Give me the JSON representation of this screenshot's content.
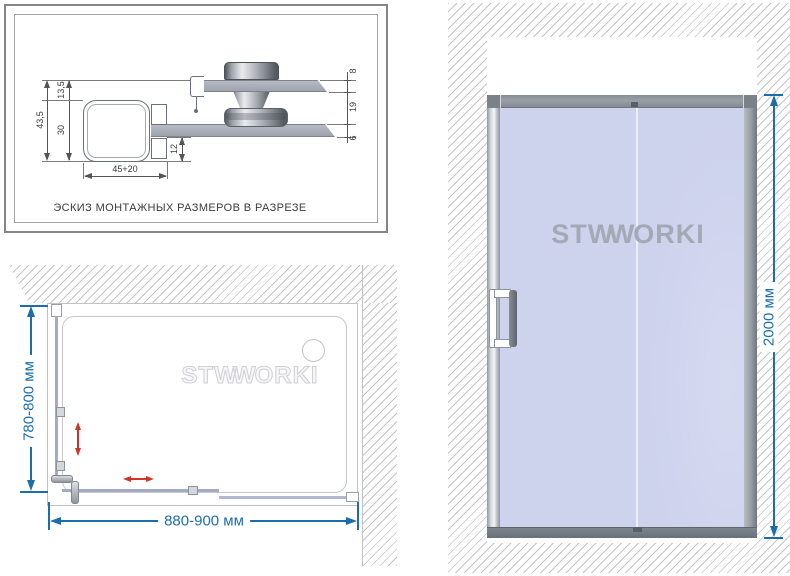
{
  "sketch": {
    "caption": "ЭСКИЗ МОНТАЖНЫХ РАЗМЕРОВ В РАЗРЕЗЕ",
    "dims": {
      "total_height": "43,5",
      "offset_top": "13,5",
      "profile_height": "30",
      "offset_bottom": "12",
      "profile_width": "45+20",
      "door_glass_thickness": "8",
      "glass_gap": "19",
      "fixed_glass_thickness": "6"
    }
  },
  "plan": {
    "depth_label": "780-800 мм",
    "width_label": "880-900 мм"
  },
  "front": {
    "height_label": "2000 мм"
  },
  "brand": {
    "part1": "ST",
    "part2": "WW",
    "part3": "ORKI"
  },
  "colors": {
    "dimension_blue": "#1d6dac",
    "arrow_red": "#cf3526",
    "glass_blue": "#cdd2ed",
    "hatch_gray": "#c5c5c5",
    "metal_gray": "#9aa0a8",
    "drawing_line": "#555555"
  }
}
